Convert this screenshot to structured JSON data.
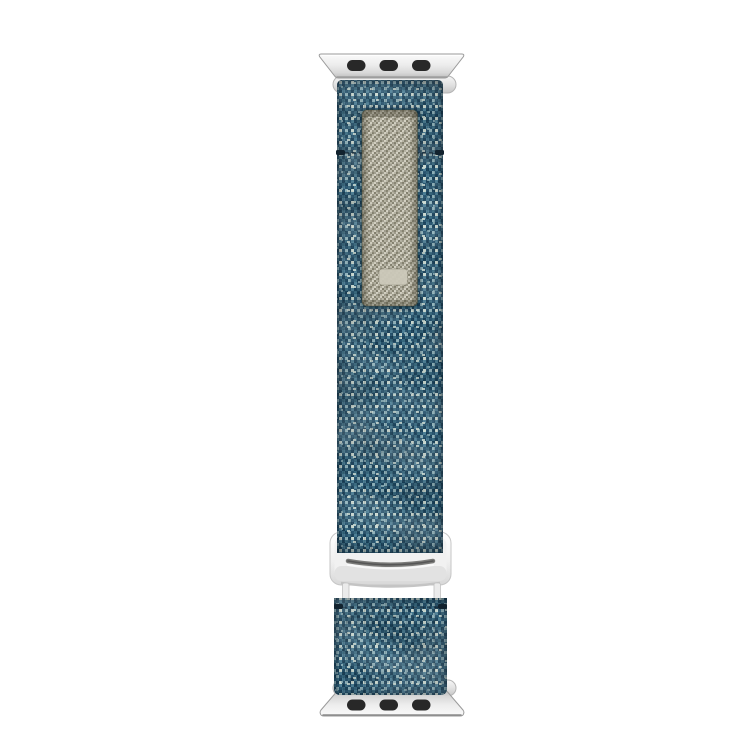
{
  "canvas": {
    "width": 750,
    "height": 750
  },
  "product": {
    "kind": "watch-band-product-photo",
    "band_style": "woven-sport-loop",
    "band_color_name": "denim-blue",
    "hardware_color_name": "silver",
    "parts": {
      "top_adapter": "top lug adapter",
      "upper_strap": "upper woven strap",
      "pull_tab": "khaki hook-and-loop pull tab",
      "buckle": "silver g-hook buckle",
      "lower_loop": "lower woven loop",
      "bottom_adapter": "bottom lug adapter"
    }
  },
  "colors": {
    "background": "#ffffff",
    "band_base": "#35687f",
    "band_palette": [
      "#16405a",
      "#24536f",
      "#35687f",
      "#4a7f97",
      "#8fb4bd",
      "#cfdfd6"
    ],
    "patch_base": "#aeab9c",
    "patch_palette": [
      "#85826f",
      "#a19e8d",
      "#b8b5a4",
      "#d6d3c4"
    ],
    "patch_label": "#ccc9ba",
    "slot": "#282828",
    "seam": "#12222e",
    "metal_stops": [
      "#fafafa",
      "#ededed",
      "#d8d8d8",
      "#bdbdbd"
    ],
    "metal_bar_stops": [
      "#f6f6f6",
      "#e2e2e2",
      "#c6c6c6"
    ],
    "buckle_stops": [
      "#ffffff",
      "#f0f0f0",
      "#d8d8d8"
    ],
    "metal_edge": "#9a9a9a",
    "buckle_edge": "#c4c4c4",
    "buckle_slot": "#7a7a78",
    "post": "#ebebeb",
    "post_edge": "#c2c2c2"
  }
}
